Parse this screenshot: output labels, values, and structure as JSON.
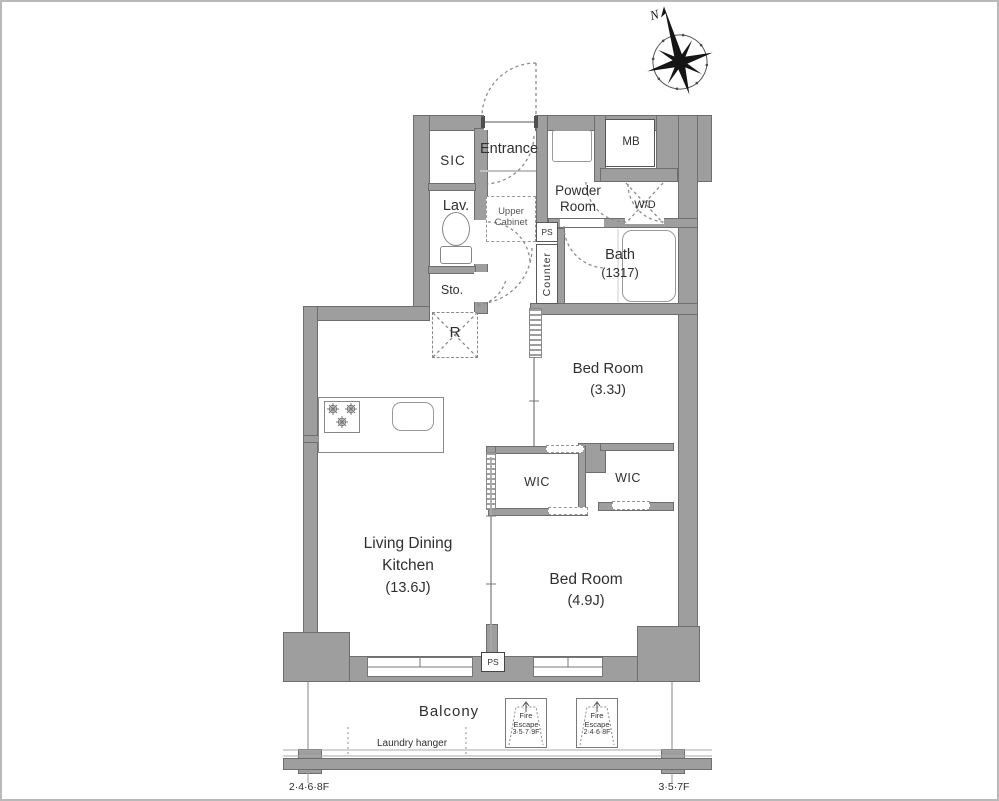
{
  "colors": {
    "bg": "#ffffff",
    "wall": "#9e9e9e",
    "wall_edge": "#6e6e6e",
    "line": "#8c8c8c",
    "text": "#2f2f2f"
  },
  "compass": {
    "label": "N"
  },
  "rooms": {
    "sic": {
      "label": "SIC"
    },
    "entrance": {
      "label": "Entrance"
    },
    "lav": {
      "label": "Lav."
    },
    "upper_cabinet": {
      "line1": "Upper",
      "line2": "Cabinet"
    },
    "powder": {
      "line1": "Powder",
      "line2": "Room"
    },
    "wd": {
      "label": "W/D"
    },
    "mb": {
      "label": "MB"
    },
    "ps_top": {
      "label": "PS"
    },
    "counter": {
      "label": "Counter"
    },
    "bath": {
      "label": "Bath",
      "size": "(1317)"
    },
    "sto": {
      "label": "Sto."
    },
    "fridge": {
      "label": "R"
    },
    "bedroom1": {
      "label": "Bed Room",
      "size": "(3.3J)"
    },
    "wic_left": {
      "label": "WIC"
    },
    "wic_right": {
      "label": "WIC"
    },
    "ldk": {
      "line1": "Living Dining",
      "line2": "Kitchen",
      "size": "(13.6J)"
    },
    "bedroom2": {
      "label": "Bed Room",
      "size": "(4.9J)"
    },
    "ps_bottom": {
      "label": "PS"
    },
    "balcony": {
      "label": "Balcony"
    },
    "laundry": {
      "label": "Laundry hanger"
    },
    "fire_escape_left": {
      "line1": "Fire",
      "line2": "Escape",
      "line3": "3·5·7·9F"
    },
    "fire_escape_right": {
      "line1": "Fire",
      "line2": "Escape",
      "line3": "2·4·6·8F"
    },
    "floors_left": {
      "label": "2·4·6·8F"
    },
    "floors_right": {
      "label": "3·5·7F"
    }
  }
}
